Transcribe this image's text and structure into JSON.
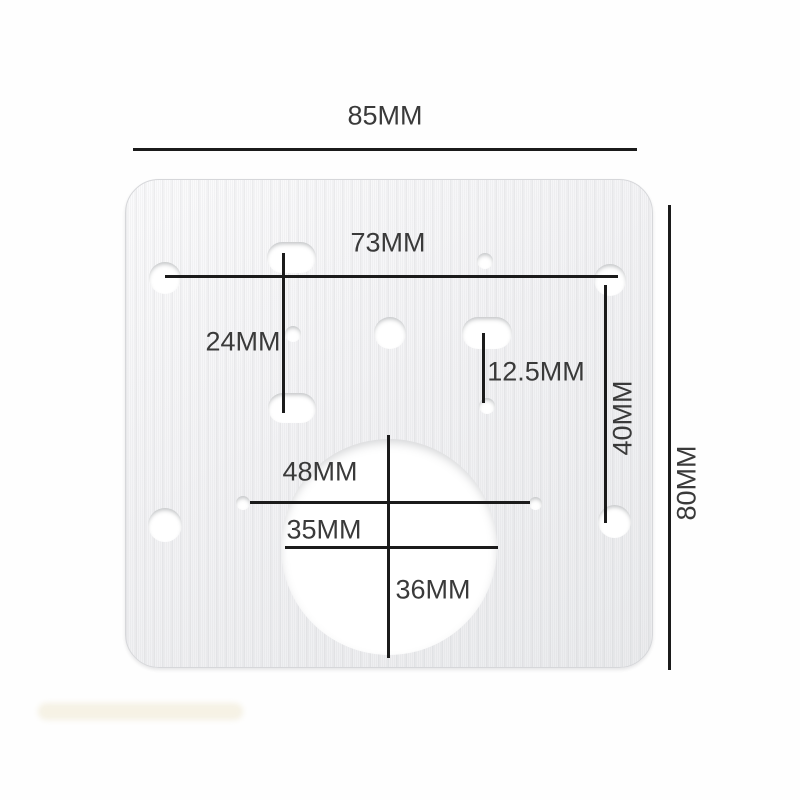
{
  "diagram": {
    "type": "product-dimension-diagram",
    "subject": "stainless hinge repair plate with dimension callouts"
  },
  "measurements": {
    "plate_width": "85MM",
    "plate_height": "80MM",
    "top_hole_span": "73MM",
    "left_hole_spacing": "24MM",
    "pilot_hole_offset": "12.5MM",
    "right_hole_spacing": "40MM",
    "side_hole_span": "48MM",
    "cup_circle_width": "35MM",
    "cup_circle_height": "36MM"
  },
  "colors": {
    "dimension_line": "#1b1b1b",
    "label_text": "#3a3a3a",
    "plate_metal": "#f3f3f5",
    "background": "#fefefe",
    "hole_fill": "#ffffff"
  }
}
